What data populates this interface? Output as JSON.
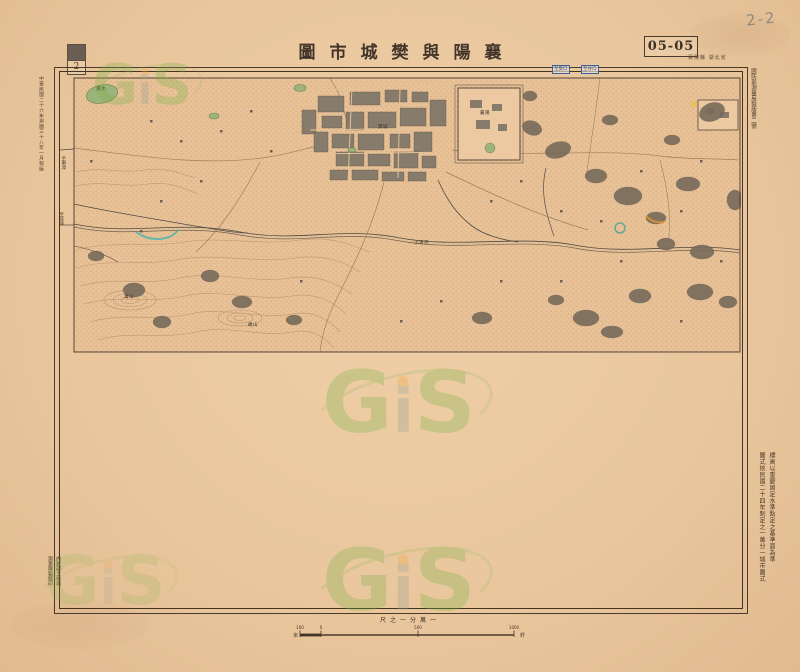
{
  "annotations": {
    "handwritten_mark": "2-2"
  },
  "header": {
    "title": "圖市城樊與陽襄",
    "sheet_number": "05-05",
    "sheet_note": "襄陽縣 湖北省",
    "stamp_char": "2"
  },
  "margins": {
    "left_imprint": "中華民國二十六年測圖三十八年一月製版",
    "right_top_note": "國防部測量局製版第二號",
    "right_notes": [
      "標高以重慶固定水準點定之基準面為準",
      "圖式依民國二十四年制定之一萬分一城市圖式"
    ],
    "bottom_left_imprint": [
      "內政部土地司",
      "測量隊製版印"
    ]
  },
  "scale": {
    "label": "尺之一分萬一",
    "unit_left": "米",
    "unit_right": "粁",
    "ticks": [
      "100",
      "0",
      "500",
      "1000"
    ]
  },
  "map": {
    "edge_labels": [
      {
        "text": "至樊口"
      },
      {
        "text": "至谷口"
      },
      {
        "text": "至南漳"
      },
      {
        "text": "至谷城"
      }
    ],
    "labels": [
      {
        "text": "樊城"
      },
      {
        "text": "襄陽"
      },
      {
        "text": "漢水"
      },
      {
        "text": "小清河"
      },
      {
        "text": "萬山"
      },
      {
        "text": "峴山"
      }
    ]
  },
  "watermark": {
    "g": "G",
    "i": "i",
    "s": "S"
  },
  "colors": {
    "paper": "#eac79e",
    "ink": "#43331f",
    "stipple": "#9c7a56",
    "vegetation": "#776b5b",
    "pond_green": "#9cb37c",
    "watermark_green": "#79b344",
    "watermark_orange": "#f0a43c",
    "edge_label_blue": "#324f86"
  }
}
